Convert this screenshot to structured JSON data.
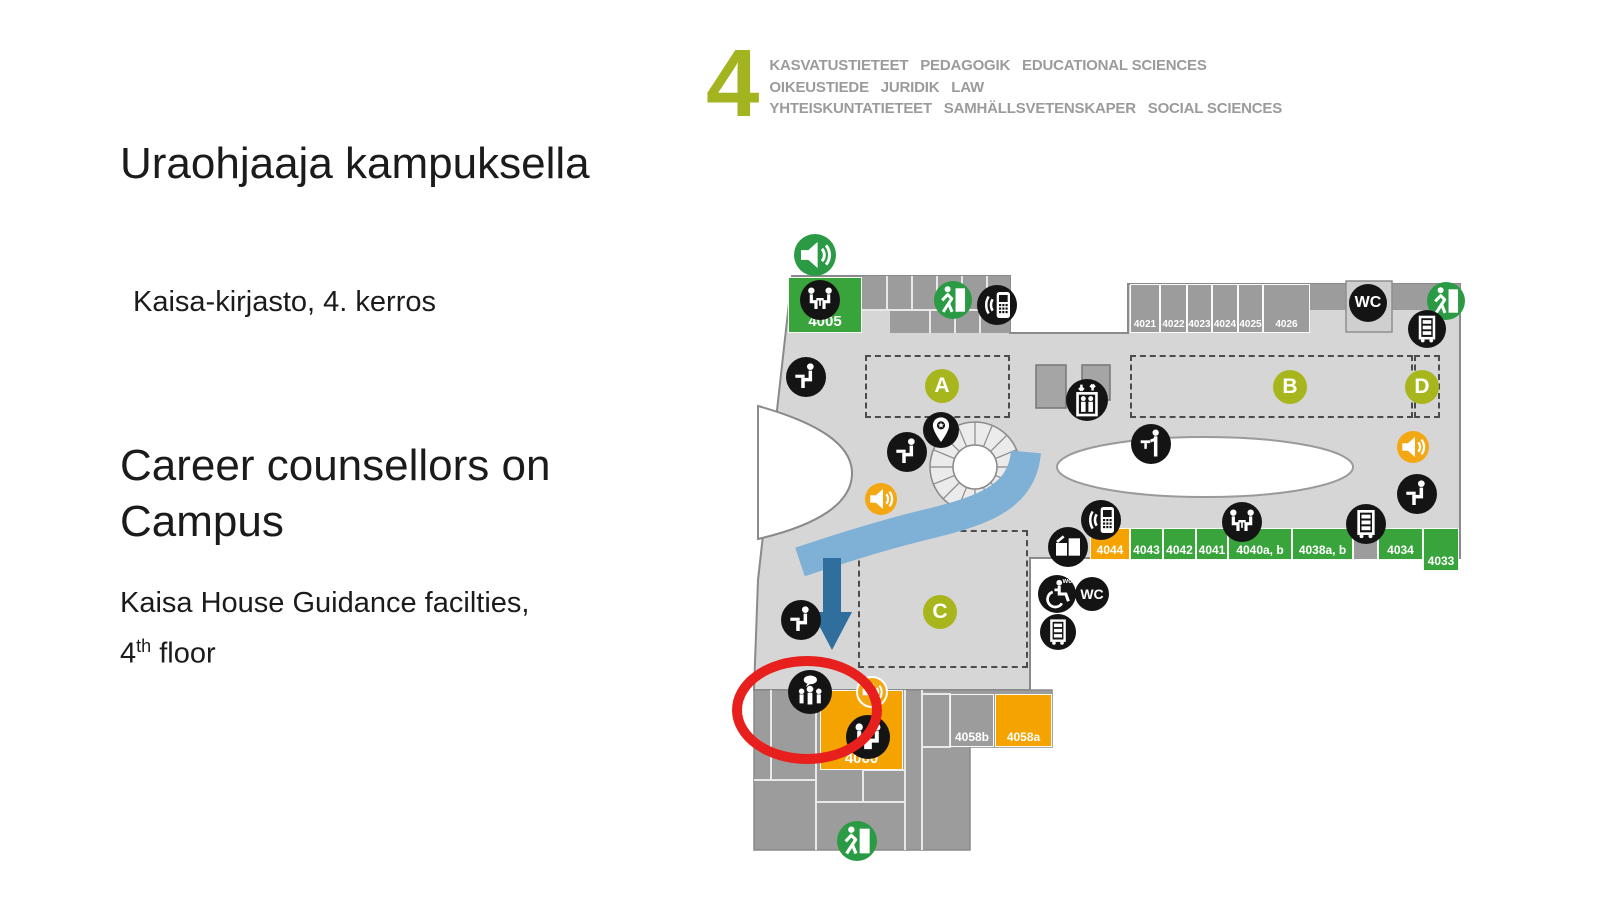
{
  "header": {
    "floor_number": "4",
    "lines": [
      "KASVATUSTIETEET   PEDAGOGIK   EDUCATIONAL SCIENCES",
      "OIKEUSTIEDE   JURIDIK   LAW",
      "YHTEISKUNTATIETEET   SAMHÄLLSVETENSKAPER   SOCIAL SCIENCES"
    ]
  },
  "intro": {
    "title_fi": "Uraohjaaja kampuksella",
    "subtitle_fi": "Kaisa-kirjasto, 4. kerros",
    "title_en": "Career counsellors on Campus",
    "subtitle_en_prefix": "Kaisa House Guidance facilties, 4",
    "subtitle_en_sup": "th",
    "subtitle_en_suffix": " floor"
  },
  "map": {
    "colors": {
      "floor": "#d6d6d6",
      "room_gray": "#9c9c9c",
      "room_green": "#3aa43c",
      "room_orange": "#f5a300",
      "zone_olive": "#a7b61c",
      "icon_black": "#141414",
      "exit_green": "#2a9b44",
      "speaker_orange": "#f3a712",
      "path_blue": "#7fb0d6",
      "arrow_blue": "#2f6e9d",
      "highlight_red": "#e8201d"
    },
    "rooms": [
      {
        "label": "4005",
        "color": "room_green",
        "x": 788,
        "y": 277,
        "w": 74,
        "h": 56,
        "fs": 15
      },
      {
        "label": "4021",
        "color": "room_gray",
        "x": 1130,
        "y": 284,
        "w": 30,
        "h": 49,
        "fs": 10
      },
      {
        "label": "4022",
        "color": "room_gray",
        "x": 1160,
        "y": 284,
        "w": 27,
        "h": 49,
        "fs": 10
      },
      {
        "label": "4023",
        "color": "room_gray",
        "x": 1187,
        "y": 284,
        "w": 25,
        "h": 49,
        "fs": 10
      },
      {
        "label": "4024",
        "color": "room_gray",
        "x": 1212,
        "y": 284,
        "w": 26,
        "h": 49,
        "fs": 10
      },
      {
        "label": "4025",
        "color": "room_gray",
        "x": 1238,
        "y": 284,
        "w": 25,
        "h": 49,
        "fs": 10
      },
      {
        "label": "4026",
        "color": "room_gray",
        "x": 1263,
        "y": 284,
        "w": 47,
        "h": 49,
        "fs": 10
      },
      {
        "label": "4044",
        "color": "room_orange",
        "x": 1090,
        "y": 528,
        "w": 40,
        "h": 32,
        "fs": 12
      },
      {
        "label": "4043",
        "color": "room_green",
        "x": 1130,
        "y": 528,
        "w": 33,
        "h": 32,
        "fs": 12
      },
      {
        "label": "4042",
        "color": "room_green",
        "x": 1163,
        "y": 528,
        "w": 33,
        "h": 32,
        "fs": 12
      },
      {
        "label": "4041",
        "color": "room_green",
        "x": 1196,
        "y": 528,
        "w": 32,
        "h": 32,
        "fs": 12
      },
      {
        "label": "4040a, b",
        "color": "room_green",
        "x": 1228,
        "y": 528,
        "w": 64,
        "h": 32,
        "fs": 12
      },
      {
        "label": "4038a, b",
        "color": "room_green",
        "x": 1292,
        "y": 528,
        "w": 61,
        "h": 32,
        "fs": 12
      },
      {
        "label": "",
        "color": "room_gray",
        "x": 1353,
        "y": 528,
        "w": 25,
        "h": 32,
        "fs": 12
      },
      {
        "label": "4034",
        "color": "room_green",
        "x": 1378,
        "y": 528,
        "w": 45,
        "h": 32,
        "fs": 12
      },
      {
        "label": "4033",
        "color": "room_green",
        "x": 1423,
        "y": 528,
        "w": 36,
        "h": 43,
        "fs": 12
      },
      {
        "label": "4060",
        "color": "room_orange",
        "x": 820,
        "y": 690,
        "w": 83,
        "h": 80,
        "fs": 15
      },
      {
        "label": "4058b",
        "color": "room_gray",
        "x": 950,
        "y": 694,
        "w": 44,
        "h": 53,
        "fs": 12
      },
      {
        "label": "4058a",
        "color": "room_orange",
        "x": 995,
        "y": 694,
        "w": 57,
        "h": 53,
        "fs": 12
      }
    ],
    "zones": [
      {
        "label": "A",
        "cx": 942,
        "cy": 386,
        "rx": 865,
        "ry": 355,
        "rw": 145,
        "rh": 63
      },
      {
        "label": "B",
        "cx": 1290,
        "cy": 387,
        "rx": 1130,
        "ry": 355,
        "rw": 283,
        "rh": 63
      },
      {
        "label": "C",
        "cx": 940,
        "cy": 612,
        "rx": 858,
        "ry": 530,
        "rw": 170,
        "rh": 138
      },
      {
        "label": "D",
        "cx": 1422,
        "cy": 387,
        "rx": 1414,
        "ry": 355,
        "rw": 26,
        "rh": 63
      }
    ],
    "icons": [
      {
        "name": "audio-guide-icon",
        "glyph": "speaker",
        "bg": "green",
        "x": 815,
        "y": 255,
        "r": 21
      },
      {
        "name": "group-room-icon",
        "glyph": "meeting",
        "bg": "black",
        "x": 820,
        "y": 300,
        "r": 20
      },
      {
        "name": "emergency-exit-icon",
        "glyph": "exit",
        "bg": "green",
        "x": 953,
        "y": 300,
        "r": 19
      },
      {
        "name": "phone-zone-icon",
        "glyph": "phone",
        "bg": "black",
        "x": 997,
        "y": 305,
        "r": 20
      },
      {
        "name": "quiet-seat-icon",
        "glyph": "seat",
        "bg": "black",
        "x": 806,
        "y": 377,
        "r": 20
      },
      {
        "name": "quiet-seat-icon",
        "glyph": "seat",
        "bg": "black",
        "x": 907,
        "y": 452,
        "r": 20
      },
      {
        "name": "info-pin-icon",
        "glyph": "pin",
        "bg": "black",
        "x": 941,
        "y": 430,
        "r": 18
      },
      {
        "name": "elevator-icon",
        "glyph": "elevator",
        "bg": "black",
        "x": 1087,
        "y": 400,
        "r": 21
      },
      {
        "name": "standing-desk-icon",
        "glyph": "standing",
        "bg": "black",
        "x": 1151,
        "y": 444,
        "r": 20
      },
      {
        "name": "audio-zone-icon",
        "glyph": "speaker",
        "bg": "orange",
        "x": 881,
        "y": 499,
        "r": 16
      },
      {
        "name": "wc-icon",
        "glyph": "",
        "label_center": "WC",
        "bg": "black",
        "x": 1368,
        "y": 303,
        "r": 19
      },
      {
        "name": "emergency-exit-icon",
        "glyph": "exit",
        "bg": "green",
        "x": 1446,
        "y": 301,
        "r": 19
      },
      {
        "name": "book-trolley-icon",
        "glyph": "trolley",
        "bg": "black",
        "x": 1427,
        "y": 329,
        "r": 19
      },
      {
        "name": "audio-zone-icon",
        "glyph": "speaker",
        "bg": "orange",
        "x": 1413,
        "y": 447,
        "r": 16
      },
      {
        "name": "quiet-seat-icon",
        "glyph": "seat",
        "bg": "black",
        "x": 1417,
        "y": 494,
        "r": 20
      },
      {
        "name": "book-trolley-icon",
        "glyph": "trolley",
        "bg": "black",
        "x": 1366,
        "y": 524,
        "r": 20
      },
      {
        "name": "group-room-icon",
        "glyph": "meeting",
        "bg": "black",
        "x": 1242,
        "y": 522,
        "r": 20
      },
      {
        "name": "phone-zone-icon",
        "glyph": "phone",
        "bg": "black",
        "x": 1101,
        "y": 520,
        "r": 20
      },
      {
        "name": "copier-icon",
        "glyph": "screens",
        "bg": "black",
        "x": 1068,
        "y": 547,
        "r": 20
      },
      {
        "name": "accessible-wc-icon",
        "glyph": "wheelchair",
        "label_corner": "wc",
        "bg": "black",
        "x": 1057,
        "y": 594,
        "r": 19
      },
      {
        "name": "wc-icon",
        "glyph": "",
        "label_center": "WC",
        "bg": "black",
        "x": 1092,
        "y": 594,
        "r": 17
      },
      {
        "name": "book-trolley-icon",
        "glyph": "trolley",
        "bg": "black",
        "x": 1058,
        "y": 632,
        "r": 18
      },
      {
        "name": "quiet-seat-icon",
        "glyph": "seat",
        "bg": "black",
        "x": 801,
        "y": 620,
        "r": 20
      },
      {
        "name": "guidance-point-icon",
        "glyph": "guidance",
        "bg": "black",
        "x": 810,
        "y": 692,
        "r": 22
      },
      {
        "name": "audio-zone-icon",
        "glyph": "speaker",
        "bg": "orange",
        "x": 872,
        "y": 692,
        "r": 16,
        "ring": true
      },
      {
        "name": "group-seating-icon",
        "glyph": "twoseats",
        "bg": "black",
        "x": 868,
        "y": 737,
        "r": 22
      },
      {
        "name": "emergency-exit-icon",
        "glyph": "exit",
        "bg": "green",
        "x": 857,
        "y": 841,
        "r": 20
      }
    ]
  }
}
